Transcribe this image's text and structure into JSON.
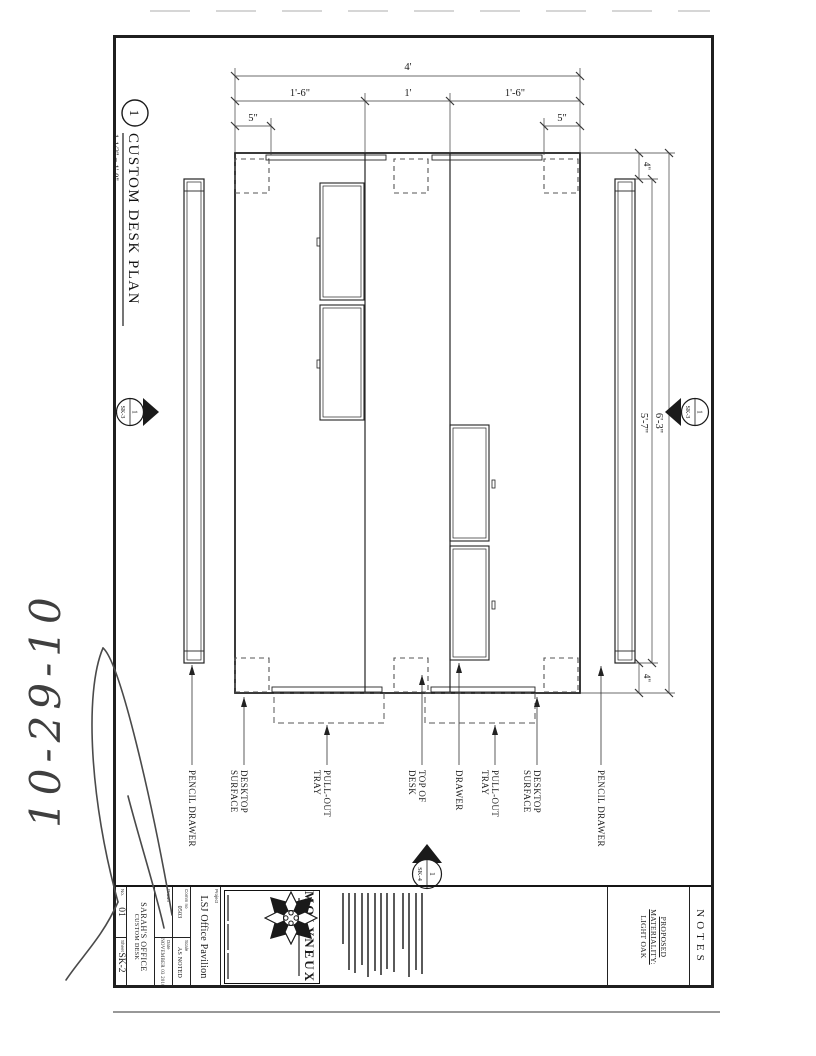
{
  "page": {
    "handwritten_date": "10-29-10"
  },
  "drawing": {
    "bubble": {
      "number": "1"
    },
    "title": "CUSTOM DESK PLAN",
    "scale": "1-1/2\" = 1'-0\"",
    "dims": {
      "depth_overall": "4'",
      "depth_segments": [
        "1'-6\"",
        "1'",
        "1'-6\""
      ],
      "corner_offset_top": "5\"",
      "corner_offset_bottom": "5\"",
      "width_overall": "6'-3\"",
      "drawer_span": "5'-7\"",
      "end_offset_left": "4\"",
      "end_offset_right": "4\""
    },
    "labels": [
      {
        "lines": [
          "PENCIL DRAWER",
          ""
        ]
      },
      {
        "lines": [
          "DESKTOP",
          "SURFACE"
        ]
      },
      {
        "lines": [
          "PULL-OUT",
          "TRAY"
        ]
      },
      {
        "lines": [
          "TOP OF",
          "DESK"
        ]
      },
      {
        "lines": [
          "DRAWER",
          ""
        ]
      },
      {
        "lines": [
          "PULL-OUT",
          "TRAY"
        ]
      },
      {
        "lines": [
          "DESKTOP",
          "SURFACE"
        ]
      },
      {
        "lines": [
          "PENCIL DRAWER",
          ""
        ]
      }
    ],
    "markers": {
      "top": {
        "num": "1",
        "sheet": "SK-3"
      },
      "bottom": {
        "num": "1",
        "sheet": "SK-3"
      },
      "right": {
        "num": "1",
        "sheet": "SK-4"
      }
    }
  },
  "title_block": {
    "notes_header": "NOTES",
    "materiality": [
      "PROPOSED",
      "MATERIALITY:",
      "LIGHT OAK"
    ],
    "firm": "MOLYNEUX",
    "project_label": "Project",
    "project_name": "LSJ Office Pavilion",
    "fields": {
      "comm_label": "Comm no",
      "comm_value": "0503",
      "scale_label": "Scale",
      "scale_value": "AS NOTED",
      "drawn_label": "Drawn",
      "drawn_value": "",
      "date_label": "Date",
      "date_value": "NOVEMBER 03 2010"
    },
    "sheet_title_1": "SARAH'S OFFICE",
    "sheet_title_2": "CUSTOM DESK",
    "rev_label": "No.",
    "rev_value": "01",
    "sheet_label": "Sheet",
    "sheet_value": "SK-2"
  }
}
